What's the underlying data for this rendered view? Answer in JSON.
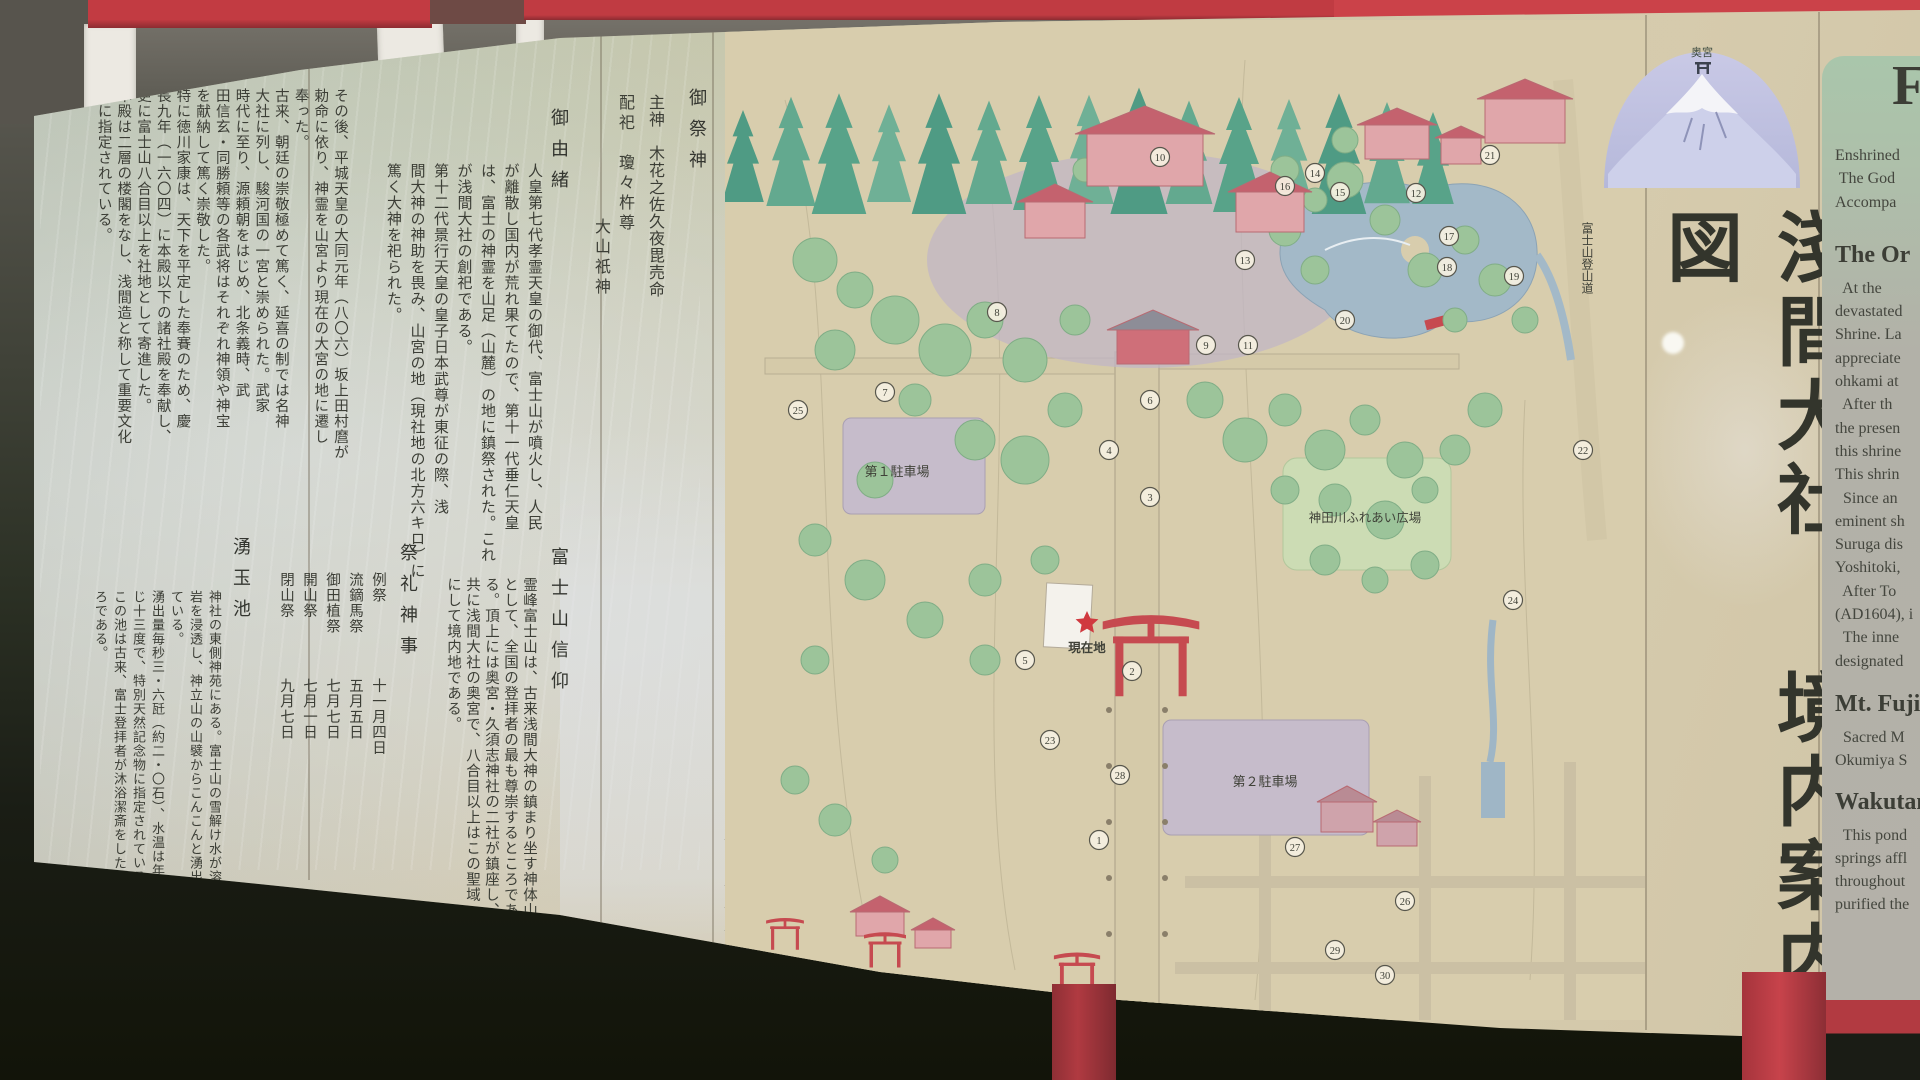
{
  "photo": {
    "description": "屋外の神社境内案内板の写真"
  },
  "board": {
    "title": {
      "part1": "淺間大社",
      "part2": "境内案内図"
    },
    "fuji_illustration": {
      "summit_label": "奥宮"
    }
  },
  "deities": {
    "heading": "御祭神",
    "main": "主神　木花之佐久夜毘売命",
    "haishi": "配祀　瓊々杵尊",
    "haishi2": "大山祇神"
  },
  "goyuisho": {
    "heading": "御由緒",
    "columns": [
      "人皇第七代孝霊天皇の御代、富士山が噴火し、人民",
      "が離散し国内が荒れ果てたので、第十一代垂仁天皇",
      "は、富士の神霊を山足（山麓）の地に鎮祭された。これ",
      "が浅間大社の創祀である。",
      "第十二代景行天皇の皇子日本武尊が東征の際、浅",
      "間大神の神助を畏み、山宮の地（現社地の北方六キロ）に",
      "篤く大神を祀られた。"
    ]
  },
  "goyuisho2": {
    "columns": [
      "その後、平城天皇の大同元年（八〇六）坂上田村麿が",
      "勅命に依り、神霊を山宮より現在の大宮の地に遷し",
      "奉った。",
      "古来、朝廷の崇敬極めて篤く、延喜の制では名神",
      "大社に列し、駿河国の一宮と崇められた。武家",
      "時代に至り、源頼朝をはじめ、北条義時、武",
      "田信玄・同勝頼等の各武将はそれぞれ神領や神宝",
      "を献納して篤く崇敬した。",
      "特に徳川家康は、天下を平定した奉賽のため、慶",
      "長九年（一六〇四）に本殿以下の諸社殿を奉献し、",
      "更に富士山八合目以上を社地として寄進した。",
      "本殿は二層の楼閣をなし、浅間造と称して重要文化",
      "財に指定されている。"
    ]
  },
  "sairei": {
    "heading": "祭礼神事",
    "festivals": [
      {
        "name": "例祭",
        "date": "十一月四日"
      },
      {
        "name": "流鏑馬祭",
        "date": "五月五日"
      },
      {
        "name": "御田植祭",
        "date": "七月七日"
      },
      {
        "name": "開山祭",
        "date": "七月一日"
      },
      {
        "name": "閉山祭",
        "date": "九月七日"
      }
    ]
  },
  "fuji_shinko": {
    "heading": "富士山信仰",
    "columns": [
      "霊峰富士山は、古来浅間大神の鎮まり坐す神体山",
      "として、全国の登拝者の最も尊崇するところであ",
      "る。頂上には奥宮・久須志神社の二社が鎮座し、",
      "共に浅間大社の奥宮で、八合目以上はこの聖域",
      "にして境内地である。"
    ]
  },
  "wakutama": {
    "heading": "湧玉池",
    "columns": [
      "神社の東側神苑にある。富士山の雪解け水が溶",
      "岩を浸透し、神立山の山襞からこんこんと湧出し",
      "ている。",
      "湧出量毎秒三・六瓩（約二・〇石）、水温は年間を通",
      "じ十三度で、特別天然記念物に指定されている。",
      "この池は古来、富士登拝者が沐浴潔斎をしたとこ",
      "ろである。"
    ]
  },
  "legend": {
    "col1": [
      {
        "no": "1.",
        "name": "大灯籠"
      },
      {
        "no": "2.",
        "name": "第二大鳥居"
      },
      {
        "no": "3.",
        "name": "石鳥居"
      },
      {
        "no": "4.",
        "name": "鏡池"
      },
      {
        "no": "5.",
        "name": "馬場"
      },
      {
        "no": "6.",
        "name": "鉾立石"
      },
      {
        "no": "7.",
        "name": "手水舎"
      },
      {
        "no": "8.",
        "name": "楼門"
      },
      {
        "no": "9.",
        "name": "祈祷殿"
      },
      {
        "no": "10.",
        "name": "拝殿"
      },
      {
        "no": "11.",
        "name": "本殿"
      },
      {
        "no": "12.",
        "name": "三之宮"
      },
      {
        "no": "13.",
        "name": "七之宮"
      },
      {
        "no": "14.",
        "name": "社務所"
      },
      {
        "no": "15.",
        "name": "水屋神社"
      }
    ],
    "col2": [
      {
        "no": "16.",
        "name": "天神社"
      },
      {
        "no": "17.",
        "name": "湧玉池"
      },
      {
        "no": "18.",
        "name": "稲荷神社"
      },
      {
        "no": "19.",
        "name": "厳島神社"
      },
      {
        "no": "20.",
        "name": "参集所"
      },
      {
        "no": "21.",
        "name": "神幸橋"
      },
      {
        "no": "22.",
        "name": "東鳥居"
      },
      {
        "no": "23.",
        "name": "公衆便所"
      },
      {
        "no": "24.",
        "name": "御手洗橋"
      },
      {
        "no": "25.",
        "name": "神田橋"
      },
      {
        "no": "26.",
        "name": "西鳥居"
      },
      {
        "no": "27.",
        "name": "忠魂碑"
      },
      {
        "no": "28.",
        "name": "流鏑馬像"
      },
      {
        "no": "29.",
        "name": "宮町交番"
      },
      {
        "no": "30.",
        "name": "公衆電話"
      }
    ]
  },
  "map": {
    "labels": {
      "parking1": "第１駐車場",
      "plaza": "神田川ふれあい広場",
      "parking2": "第２駐車場",
      "current": "現在地",
      "trail": "富士山登山道"
    },
    "markers": [
      {
        "n": "10",
        "x": 435,
        "y": 137
      },
      {
        "n": "12",
        "x": 691,
        "y": 173
      },
      {
        "n": "16",
        "x": 560,
        "y": 166
      },
      {
        "n": "14",
        "x": 590,
        "y": 153
      },
      {
        "n": "15",
        "x": 615,
        "y": 172
      },
      {
        "n": "21",
        "x": 765,
        "y": 135
      },
      {
        "n": "17",
        "x": 724,
        "y": 216
      },
      {
        "n": "18",
        "x": 722,
        "y": 247
      },
      {
        "n": "19",
        "x": 789,
        "y": 256
      },
      {
        "n": "13",
        "x": 520,
        "y": 240
      },
      {
        "n": "8",
        "x": 272,
        "y": 292
      },
      {
        "n": "9",
        "x": 481,
        "y": 325
      },
      {
        "n": "11",
        "x": 523,
        "y": 325
      },
      {
        "n": "20",
        "x": 620,
        "y": 300
      },
      {
        "n": "6",
        "x": 425,
        "y": 380
      },
      {
        "n": "7",
        "x": 160,
        "y": 372
      },
      {
        "n": "4",
        "x": 384,
        "y": 430
      },
      {
        "n": "3",
        "x": 425,
        "y": 477
      },
      {
        "n": "25",
        "x": 73,
        "y": 390
      },
      {
        "n": "22",
        "x": 858,
        "y": 430
      },
      {
        "n": "24",
        "x": 788,
        "y": 580
      },
      {
        "n": "2",
        "x": 407,
        "y": 651
      },
      {
        "n": "5",
        "x": 300,
        "y": 640
      },
      {
        "n": "23",
        "x": 325,
        "y": 720
      },
      {
        "n": "28",
        "x": 395,
        "y": 755
      },
      {
        "n": "26",
        "x": 680,
        "y": 881
      },
      {
        "n": "1",
        "x": 374,
        "y": 820
      },
      {
        "n": "27",
        "x": 570,
        "y": 827
      },
      {
        "n": "29",
        "x": 610,
        "y": 930
      },
      {
        "n": "30",
        "x": 660,
        "y": 955
      }
    ]
  },
  "english": {
    "title_fragment": "F",
    "intro": [
      "Enshrined",
      " The God",
      "Accompa"
    ],
    "origin_heading": "The Or",
    "origin": [
      "  At the",
      "devastated",
      "Shrine. La",
      "appreciate",
      "ohkami at",
      "  After th",
      "the presen",
      "this shrine",
      "This shrin",
      "  Since an",
      "eminent sh",
      "Suruga dis",
      "Yoshitoki,",
      "  After To",
      "(AD1604), i",
      "  The inne",
      "designated"
    ],
    "fuji_heading": "Mt. Fuji",
    "fuji": [
      "  Sacred M",
      "Okumiya S"
    ],
    "wakutama_heading": "Wakutam",
    "wakutama": [
      "  This pond",
      "springs affl",
      "throughout",
      "purified the"
    ]
  },
  "colors": {
    "frame_red": "#c23b42",
    "board_beige": "#d4c9ab",
    "ink": "#3c3e36",
    "accent_red": "#c03a3f",
    "tree_green": "#4f9b84",
    "building_pink": "#e0a6aa",
    "pond_blue": "#a3b9c8",
    "english_panel_green": "#a9c6ab"
  }
}
